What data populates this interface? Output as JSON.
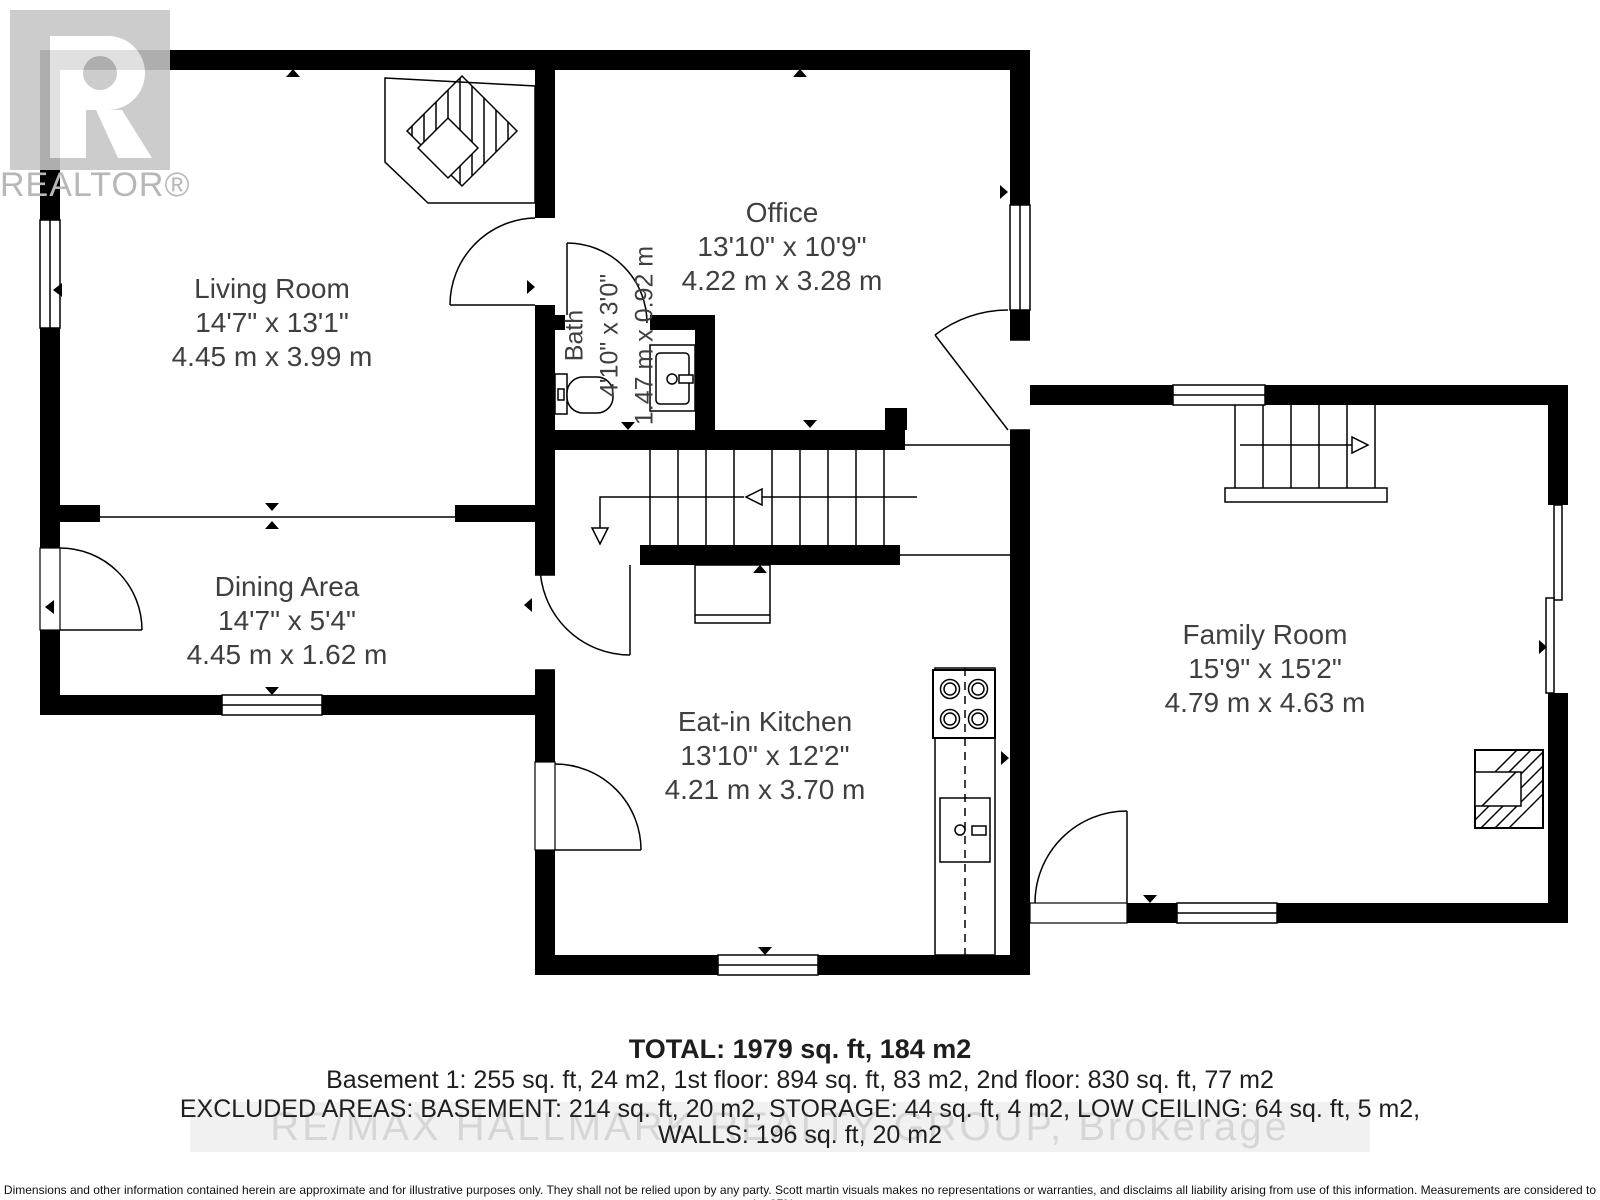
{
  "branding": {
    "logo_caption": "REALTOR®"
  },
  "floorplan": {
    "rooms": [
      {
        "name": "Living Room",
        "imperial": "14'7\" x 13'1\"",
        "metric": "4.45 m x 3.99 m"
      },
      {
        "name": "Office",
        "imperial": "13'10\" x 10'9\"",
        "metric": "4.22 m x 3.28 m"
      },
      {
        "name": "Bath",
        "imperial": "4'10\" x 3'0\"",
        "metric": "1.47 m x 0.92 m"
      },
      {
        "name": "Dining Area",
        "imperial": "14'7\" x 5'4\"",
        "metric": "4.45 m x 1.62 m"
      },
      {
        "name": "Eat-in Kitchen",
        "imperial": "13'10\" x 12'2\"",
        "metric": "4.21 m x 3.70 m"
      },
      {
        "name": "Family Room",
        "imperial": "15'9\" x 15'2\"",
        "metric": "4.79 m x 4.63 m"
      }
    ]
  },
  "summary": {
    "total": "TOTAL: 1979 sq. ft, 184 m2",
    "line2": "Basement 1: 255 sq. ft, 24 m2, 1st floor: 894 sq. ft, 83 m2, 2nd floor: 830 sq. ft, 77 m2",
    "line3": "EXCLUDED AREAS: BASEMENT: 214 sq. ft, 20 m2, STORAGE: 44 sq. ft, 4 m2, LOW CEILING: 64 sq. ft, 5 m2,",
    "line4": "WALLS: 196 sq. ft, 20 m2"
  },
  "watermark": "RE/MAX HALLMARK REALTY GROUP, Brokerage",
  "disclaimer": "Dimensions and other information contained herein are approximate and for illustrative purposes only. They shall not be relied upon by any party. Scott martin visuals makes no representations or warranties, and disclaims all liability arising from use of this information. Measurements are considered to be 97% accurate.",
  "colors": {
    "wall": "#000000",
    "label_text": "#3f3f3f",
    "logo_gray": "#c6c6c6",
    "watermark_text": "#d6d6d6",
    "watermark_bg": "#f1f1f1"
  }
}
